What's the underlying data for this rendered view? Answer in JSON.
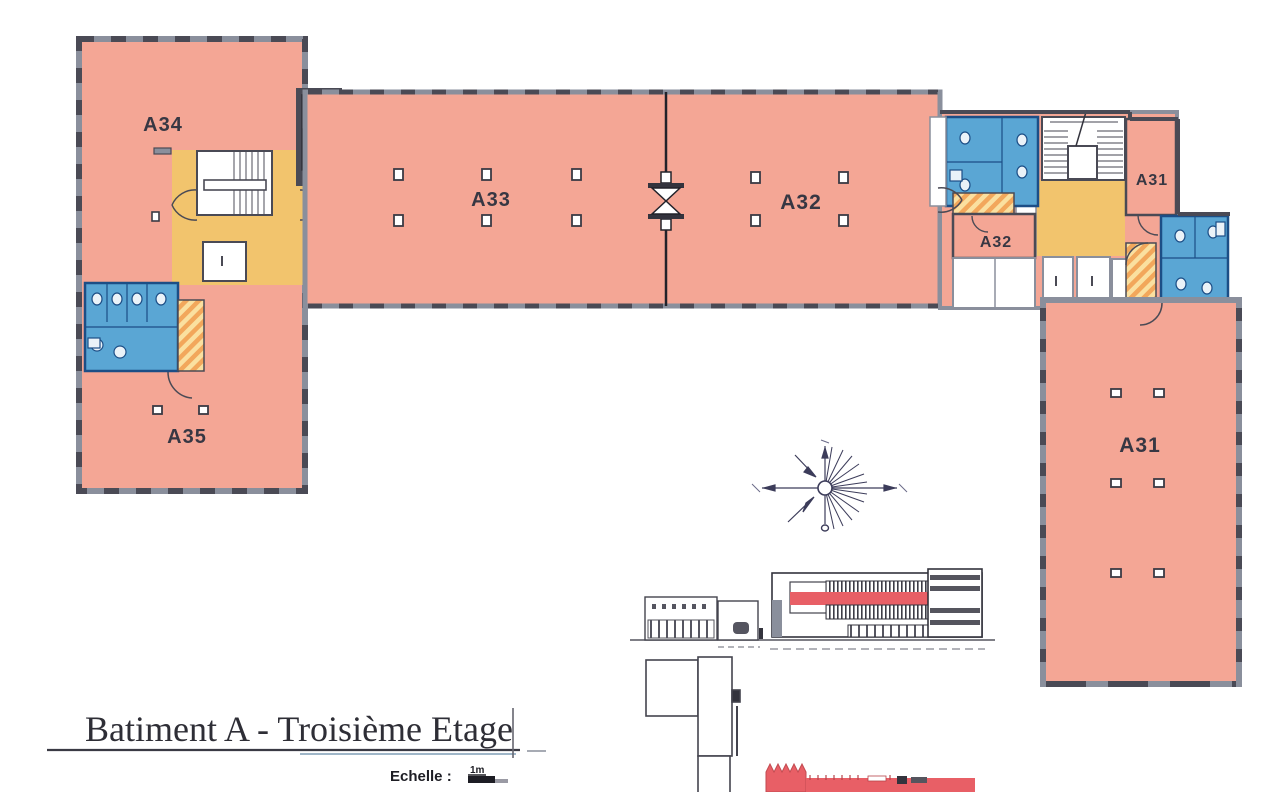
{
  "title_block": {
    "title": "Batiment A - Troisième Etage",
    "scale_label": "Echelle :",
    "scale_value": "1m"
  },
  "plan": {
    "rooms": {
      "a34": "A34",
      "a35": "A35",
      "a33": "A33",
      "a32": "A32",
      "a32_annex": "A32",
      "a31_annex": "A31",
      "a31": "A31"
    }
  },
  "legend_icons": {
    "compass_rose": "compass-rose",
    "elevation_view": "building-elevation",
    "key_plan": "key-plan-outline"
  },
  "colors": {
    "room_fill": "#f4a695",
    "circulation_fill": "#f2c46d",
    "sanitary_fill": "#5aa6d4",
    "ramp_hatch_orange": "#f2a75b",
    "ramp_hatch_yellow": "#fae0a0",
    "wall_gray": "#8a8f9c",
    "wall_dark": "#4a4a55",
    "floor_highlight_red": "#e85f66",
    "label_color": "#373743"
  }
}
